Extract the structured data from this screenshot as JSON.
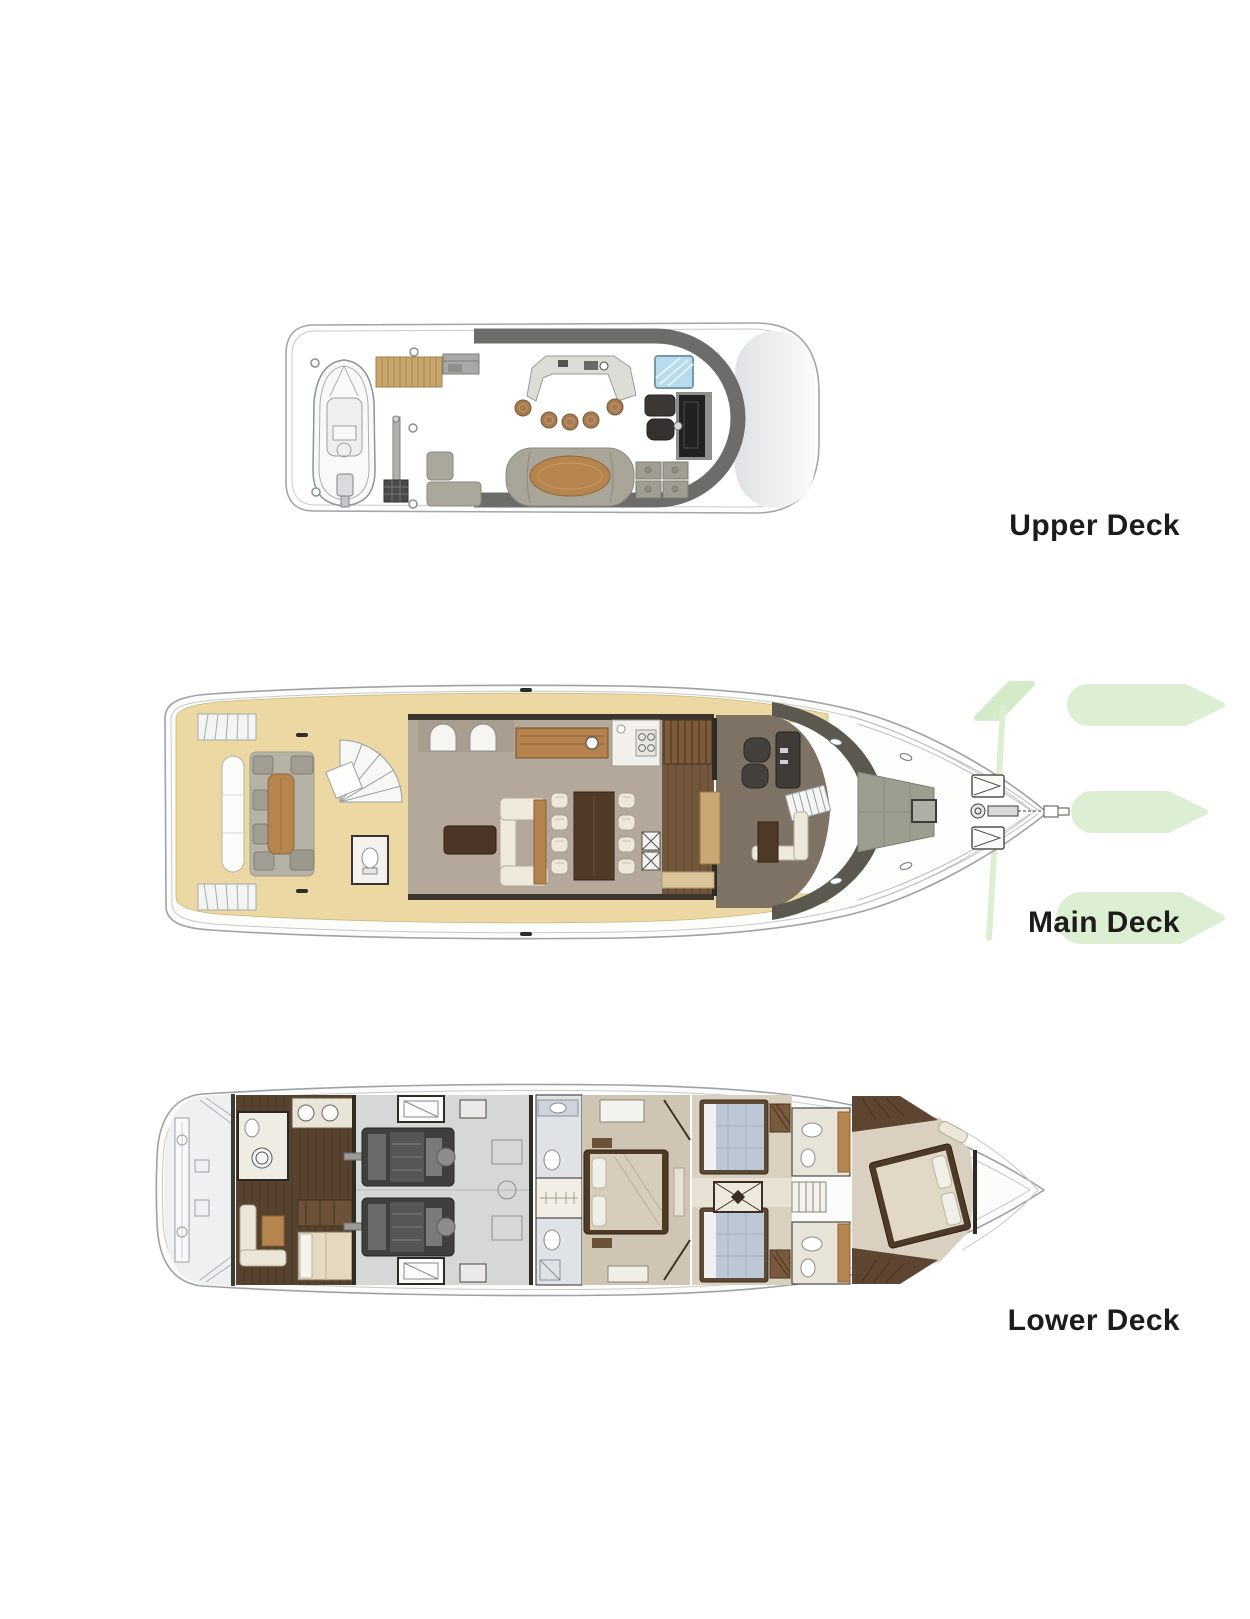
{
  "page": {
    "background_color": "#ffffff"
  },
  "labels": {
    "upper_deck": "Upper Deck",
    "main_deck": "Main Deck",
    "lower_deck": "Lower Deck"
  },
  "label_style": {
    "color": "#1d1c1a",
    "font_size_px": 30,
    "font_weight": "bold"
  },
  "watermark": {
    "name": "green-leaf-logo-watermark",
    "color_light": "#dcefd3",
    "color_mid": "#d3ebc8"
  },
  "colors": {
    "hull_line": "#9da2a5",
    "hardtop_band": "#6c6c6a",
    "teak_deck": "#ecd8a2",
    "teak_wood": "#c9a66b",
    "salon_floor": "#b3a89a",
    "dark_wood": "#56422f",
    "cream_upholstery": "#efe9db",
    "gray_upholstery": "#a9a599",
    "table_wood": "#b5854d",
    "dark_table": "#4a3526",
    "skylight_blue": "#b7dcec",
    "guest_bed_blue": "#bcc8d6",
    "engine_dark": "#3f3f3d",
    "windshield_dark": "#5b594f"
  },
  "decks": {
    "upper": {
      "label_ref": "labels.upper_deck",
      "features": [
        "tender-with-outboard",
        "teak-stairs",
        "crane-davit",
        "grill-unit",
        "wet-bar-counter",
        "bar-stools",
        "skylight",
        "dining-set",
        "tv-cabinet",
        "oval-table-lounge",
        "l-sofa",
        "storage-cabinets"
      ]
    },
    "main": {
      "label_ref": "labels.main_deck",
      "features": [
        "aft-deck-lounge",
        "transom-bench",
        "aft-stairs",
        "spiral-staircase",
        "day-head",
        "salon-sofa",
        "coffee-table",
        "dining-table-eight-chairs",
        "arched-windows",
        "sideboard",
        "galley",
        "stairs-to-flybridge",
        "helm-station-two-seats",
        "observation-sofa",
        "bow-sunpad",
        "deck-hatches",
        "anchor-windlass"
      ]
    },
    "lower": {
      "label_ref": "labels.lower_deck",
      "features": [
        "swim-platform",
        "passerelle-gear",
        "crew-mess",
        "crew-cabin",
        "crew-bathroom",
        "engine-room-twin-engines",
        "master-stateroom",
        "master-bathroom",
        "walk-in-closet",
        "twin-guest-cabins",
        "guest-bathrooms",
        "corridor-rug",
        "vip-bow-cabin"
      ]
    }
  }
}
